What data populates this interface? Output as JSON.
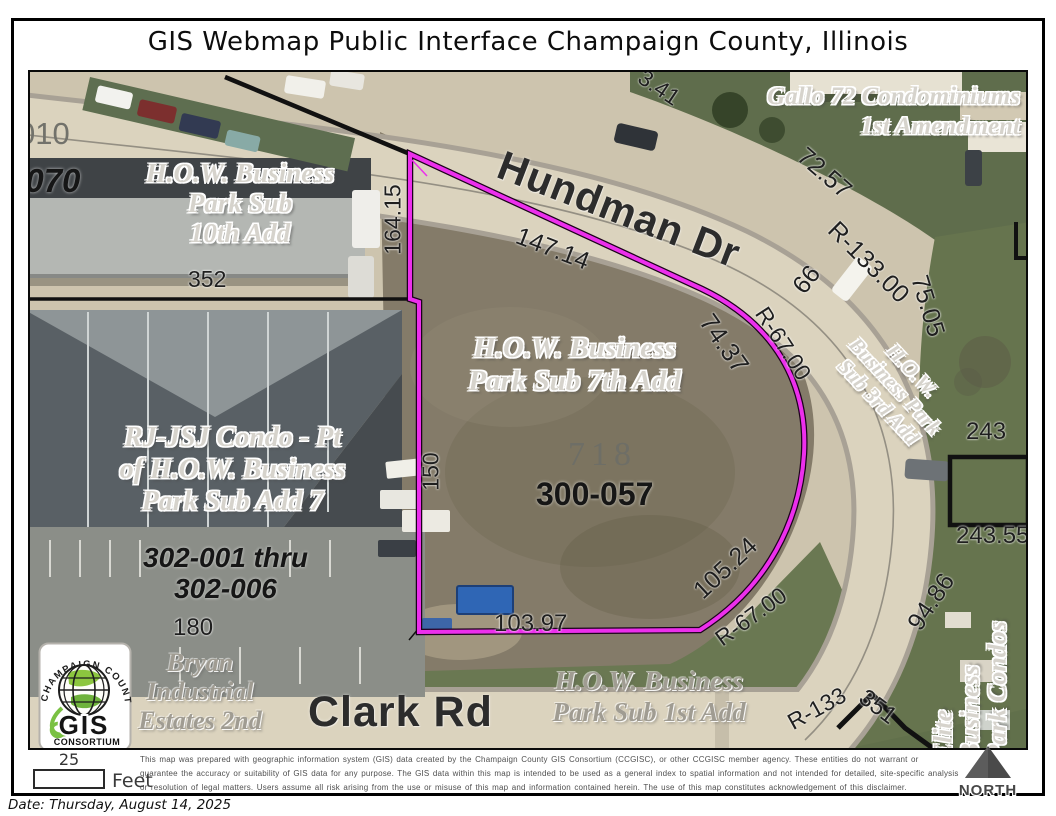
{
  "title": "GIS Webmap Public Interface Champaign County, Illinois",
  "map": {
    "streets": {
      "hundman": "Hundman Dr",
      "clark": "Clark Rd"
    },
    "subdivisions": {
      "gallo": [
        "Gallo 72 Condominiums",
        "1st Amendment"
      ],
      "how_10th": [
        "H.O.W. Business",
        "Park Sub",
        "10th Add"
      ],
      "how_7th": [
        "H.O.W. Business",
        "Park Sub 7th Add"
      ],
      "how_3rd": [
        "H.O.W.",
        "Business Park",
        "Sub 3rd Add"
      ],
      "how_1st": [
        "H.O.W. Business",
        "Park Sub 1st Add"
      ],
      "rjjsj": [
        "RJ-JSJ Condo - Pt",
        "of H.O.W. Business",
        "Park Sub Add 7"
      ],
      "bryan": [
        "Bryan",
        "Industrial",
        "Estates 2nd"
      ],
      "elite": [
        "Elite",
        "Business",
        "Park Condos"
      ]
    },
    "parcel_ids": {
      "p010": "010",
      "p070": "0-070",
      "p718": "718",
      "p300_057": "300-057",
      "p302_range_1": "302-001 thru",
      "p302_range_2": "302-006",
      "p180": "180"
    },
    "dimensions": {
      "d352": "352",
      "d164_15": "164.15",
      "d147_14": "147.14",
      "d3_41": "3.41",
      "d72_57": "72.57",
      "r133_00": "R-133.00",
      "d75_05": "75.05",
      "d66": "66",
      "d74_37": "74.37",
      "r67_00_ne": "R-67.00",
      "d150": "150",
      "d103_97": "103.97",
      "d105_24": "105.24",
      "r67_00_s": "R-67.00",
      "r133_s": "R-133",
      "d243": "243",
      "d243_55": "243.55",
      "d94_86": "94.86",
      "d351": "351"
    }
  },
  "logo": {
    "arc": "CHAMPAIGN COUNTY",
    "gis": "GIS",
    "consortium": "CONSORTIUM"
  },
  "footer": {
    "scale_value": "25",
    "scale_unit": "Feet",
    "disclaimer": [
      "This map was prepared with geographic information system (GIS) data created by the Champaign County GIS Consortium (CCGISC), or other CCGISC member agency. These entities do not warrant or",
      "guarantee the accuracy or suitability of GIS data for any purpose. The GIS data within this map is intended to be used as a general index to spatial information and not intended for detailed, site-specific analysis",
      "or resolution of legal matters. Users assume all risk arising from the use or misuse of this map and information contained herein. The use of this map constitutes acknowledgement of this disclaimer."
    ],
    "north_label": "NORTH",
    "date_line": "Date: Thursday, August 14, 2025"
  },
  "colors": {
    "parcel_highlight": "#ec2fec",
    "boundary_black": "#111111"
  }
}
